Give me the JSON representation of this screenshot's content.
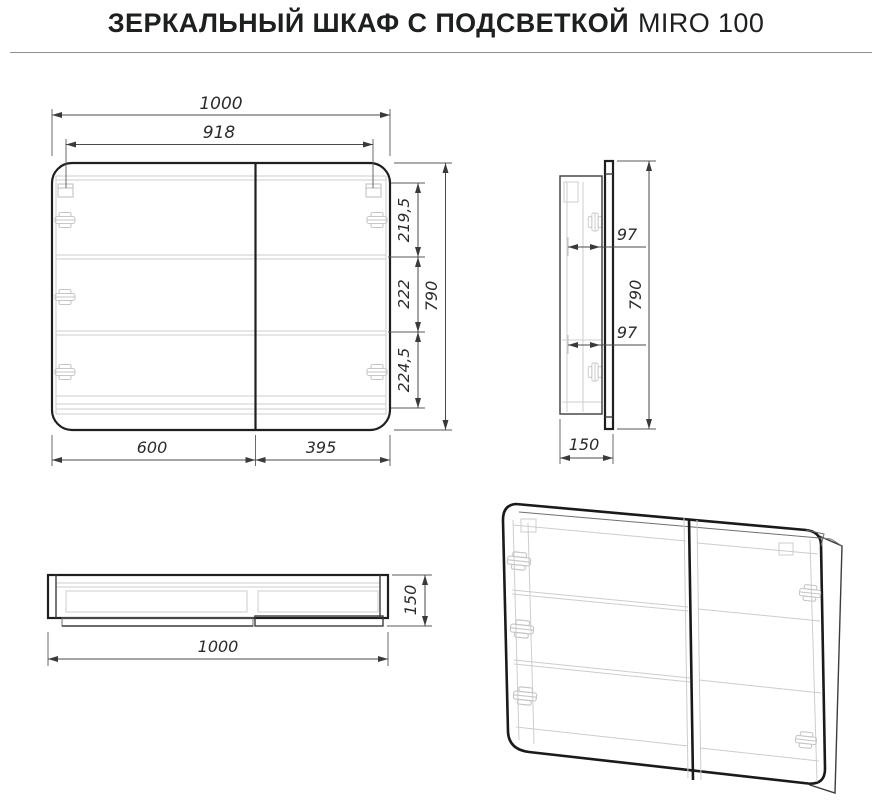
{
  "title": {
    "main": "ЗЕРКАЛЬНЫЙ ШКАФ С ПОДСВЕТКОЙ",
    "model": "MIRO 100"
  },
  "drawing_type": "furniture technical drawing, three orthographic views and one perspective wireframe view of a two-door mirror cabinet",
  "units": "mm",
  "dimensions": {
    "front": {
      "total_width": "1000",
      "mounting_width": "918",
      "top_section": "219,5",
      "middle_section": "222",
      "bottom_section": "224,5",
      "total_height": "790",
      "left_door_width": "600",
      "right_door_width": "395"
    },
    "side": {
      "upper_hinge_depth": "97",
      "lower_hinge_depth": "97",
      "total_height": "790",
      "total_depth": "150"
    },
    "top": {
      "total_width": "1000",
      "total_depth": "150"
    }
  },
  "colors": {
    "background": "#ffffff",
    "main_outline": "#1f1f1f",
    "dimension_lines": "#4a4a4a",
    "hidden_detail_lines": "#cdcdcd",
    "text": "#2b2b2b",
    "separator_rule": "#8f8f8f"
  }
}
